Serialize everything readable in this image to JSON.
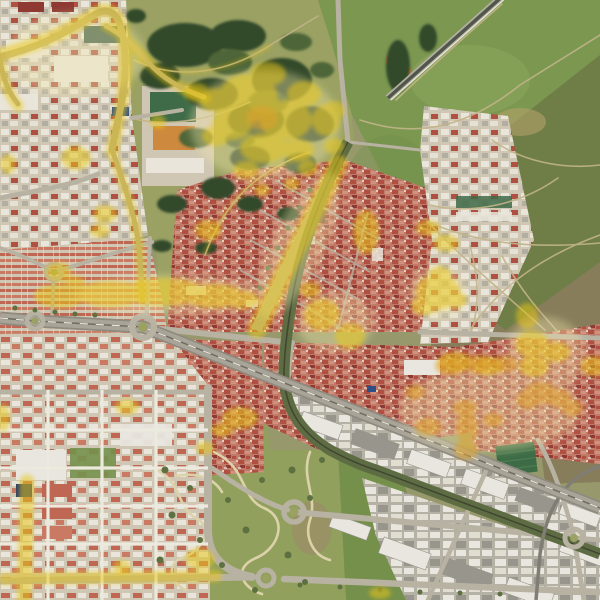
{
  "meta": {
    "view": "satellite-aerial-map",
    "width_px": 600,
    "height_px": 600,
    "visible_text": "none",
    "description": "Aerial imagery of a city with yellow analysis-overlay highlights on selected roads, parks and building clusters"
  },
  "overlay": {
    "name": "highlighted-zones-overlay",
    "primary_color": "#e9c716",
    "halo_color": "#f2e7ae",
    "orange_color": "#dfa32b",
    "opacity": 0.52
  },
  "features": [
    {
      "name": "open-field-northeast",
      "kind": "grassland"
    },
    {
      "name": "scrubland-east",
      "kind": "scrub with dirt trails"
    },
    {
      "name": "city-park-north",
      "kind": "park with tree clusters"
    },
    {
      "name": "city-park-south",
      "kind": "park with winding paths"
    },
    {
      "name": "old-town",
      "kind": "dense red-roof urban"
    },
    {
      "name": "row-house-district-west",
      "kind": "residential"
    },
    {
      "name": "planned-suburb-southwest",
      "kind": "residential grid"
    },
    {
      "name": "industrial-estate-southeast",
      "kind": "warehouses"
    },
    {
      "name": "ring-road-highway",
      "kind": "road"
    },
    {
      "name": "railway-corridor",
      "kind": "rail"
    },
    {
      "name": "boulevard-highlighted",
      "kind": "road"
    },
    {
      "name": "top-left-avenue-highlighted",
      "kind": "road"
    },
    {
      "name": "roundabouts",
      "kind": "road junctions"
    },
    {
      "name": "football-pitch",
      "kind": "sports field"
    },
    {
      "name": "school-courts",
      "kind": "sports courts"
    },
    {
      "name": "orange-roof-compound",
      "kind": "building"
    },
    {
      "name": "yellow-highlight-blobs",
      "kind": "overlay markings"
    }
  ],
  "palette": {
    "base": "#97996d",
    "fieldGreen": "#7b9750",
    "fieldLight": "#8da75c",
    "fieldDark": "#74904b",
    "olive": "#6e7b46",
    "scrub": "#877d5a",
    "scrubDark": "#6f6549",
    "parkGrass": "#9aa163",
    "parkLawn": "#92a05e",
    "treeDark": "#31482a",
    "treeMid": "#4d6537",
    "shrub": "#5d7040",
    "pathTan": "#dcd2aa",
    "trailTan": "#c2b489",
    "roadLight": "#b8b2a3",
    "roadMid": "#a9a498",
    "roadCasing": "#8e8a7f",
    "asphaltDark": "#6d6a62",
    "roadDark": "#50564a",
    "roadWhite": "#eceade",
    "railGreen": "#5e6c43",
    "railDark": "#3f4531",
    "oldtownBase": "#c07a68",
    "oldtownRed": "#b05043",
    "oldtownDark": "#8e3a33",
    "oldtownLight": "#d2907e",
    "white": "#e9e5da",
    "grayBld": "#b3aea2",
    "darkGray": "#807d74",
    "brown": "#6f5348",
    "suburbBase": "#cfc6b3",
    "suburbRed": "#bf6752",
    "suburbRed2": "#ca7a63",
    "indBase": "#b5b1a4",
    "indWhite": "#e8e6df",
    "indGray": "#98958c",
    "courtGreen": "#3f6b48",
    "courtTeal": "#3a5a46",
    "courtOrange": "#cd8a3e",
    "pitchGreen": "#3c6b45",
    "pitchLight": "#4f7d52",
    "blue": "#2e4f86",
    "navy": "#2e3f66",
    "orangeRoof": "#c57a40",
    "dirtOrange": "#c8854a",
    "dirt": "#b3a269",
    "ruin": "#9a8d68",
    "highlight": "#e9c716",
    "highlightHalo": "#f2e7ae",
    "highlightOrange": "#dfa32b"
  }
}
